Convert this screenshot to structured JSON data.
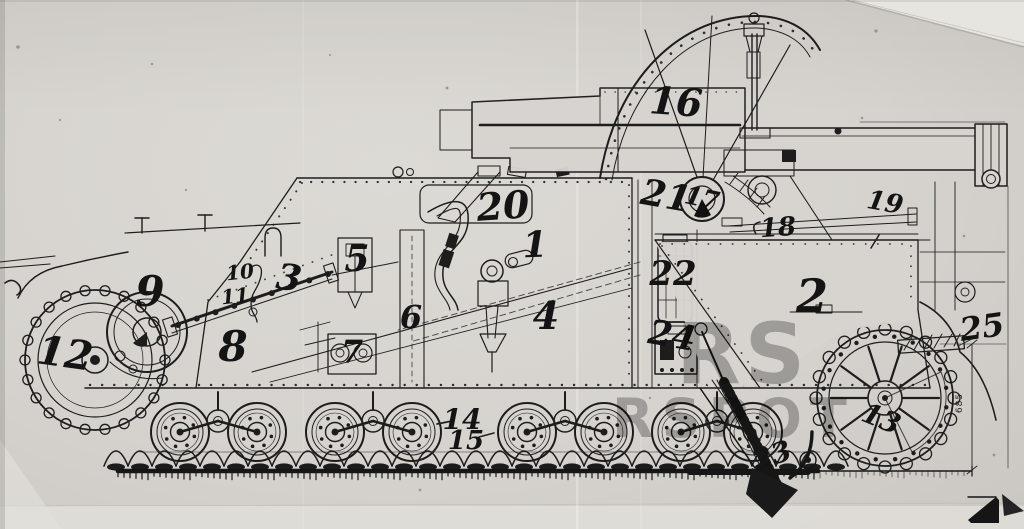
{
  "figure": {
    "subject": "Scanned side-view ink technical drawing of a tracked self-propelled gun with handwritten part callout numbers",
    "media": "ink line drawing photographed on grey paper"
  },
  "colors": {
    "paper": "#d7d4cf",
    "paper_light": "#e7e5e0",
    "ink": "#1d1d1d",
    "watermark": "#4e4e4e"
  },
  "dimension": {
    "value": "685"
  },
  "watermark": {
    "opacity": 0.38,
    "fragments": [
      {
        "text": "RS",
        "x": 676,
        "y": 312,
        "s": 84,
        "sp": 4
      },
      {
        "text": "RSPOT",
        "x": 612,
        "y": 392,
        "s": 54,
        "sp": 8
      }
    ]
  },
  "callouts": [
    {
      "n": "1",
      "x": 535,
      "y": 245,
      "s": 36,
      "r": -2
    },
    {
      "n": "2",
      "x": 812,
      "y": 296,
      "s": 46,
      "r": 0
    },
    {
      "n": "3",
      "x": 289,
      "y": 278,
      "s": 36,
      "r": 8
    },
    {
      "n": "4",
      "x": 546,
      "y": 316,
      "s": 38,
      "r": 0
    },
    {
      "n": "5",
      "x": 357,
      "y": 259,
      "s": 36,
      "r": 0
    },
    {
      "n": "6",
      "x": 411,
      "y": 317,
      "s": 32,
      "r": 0
    },
    {
      "n": "7",
      "x": 352,
      "y": 352,
      "s": 32,
      "r": 0
    },
    {
      "n": "8",
      "x": 233,
      "y": 347,
      "s": 42,
      "r": 0
    },
    {
      "n": "9",
      "x": 150,
      "y": 292,
      "s": 42,
      "r": 0
    },
    {
      "n": "10",
      "x": 240,
      "y": 272,
      "s": 20,
      "r": -6
    },
    {
      "n": "11",
      "x": 235,
      "y": 296,
      "s": 20,
      "r": -6
    },
    {
      "n": "12",
      "x": 65,
      "y": 354,
      "s": 40,
      "r": 8
    },
    {
      "n": "13",
      "x": 881,
      "y": 419,
      "s": 28,
      "r": 22
    },
    {
      "n": "14",
      "x": 462,
      "y": 420,
      "s": 28,
      "r": 0
    },
    {
      "n": "15",
      "x": 466,
      "y": 441,
      "s": 26,
      "r": 0
    },
    {
      "n": "16",
      "x": 676,
      "y": 102,
      "s": 38,
      "r": 4
    },
    {
      "n": "17",
      "x": 702,
      "y": 198,
      "s": 25,
      "r": 12
    },
    {
      "n": "18",
      "x": 778,
      "y": 228,
      "s": 26,
      "r": -4
    },
    {
      "n": "19",
      "x": 885,
      "y": 203,
      "s": 26,
      "r": 10
    },
    {
      "n": "20",
      "x": 503,
      "y": 206,
      "s": 38,
      "r": -4
    },
    {
      "n": "21",
      "x": 666,
      "y": 196,
      "s": 36,
      "r": 10
    },
    {
      "n": "22",
      "x": 673,
      "y": 274,
      "s": 34,
      "r": 0
    },
    {
      "n": "23",
      "x": 772,
      "y": 456,
      "s": 28,
      "r": -18
    },
    {
      "n": "24",
      "x": 672,
      "y": 336,
      "s": 34,
      "r": 10
    },
    {
      "n": "25",
      "x": 982,
      "y": 327,
      "s": 32,
      "r": -8
    }
  ]
}
